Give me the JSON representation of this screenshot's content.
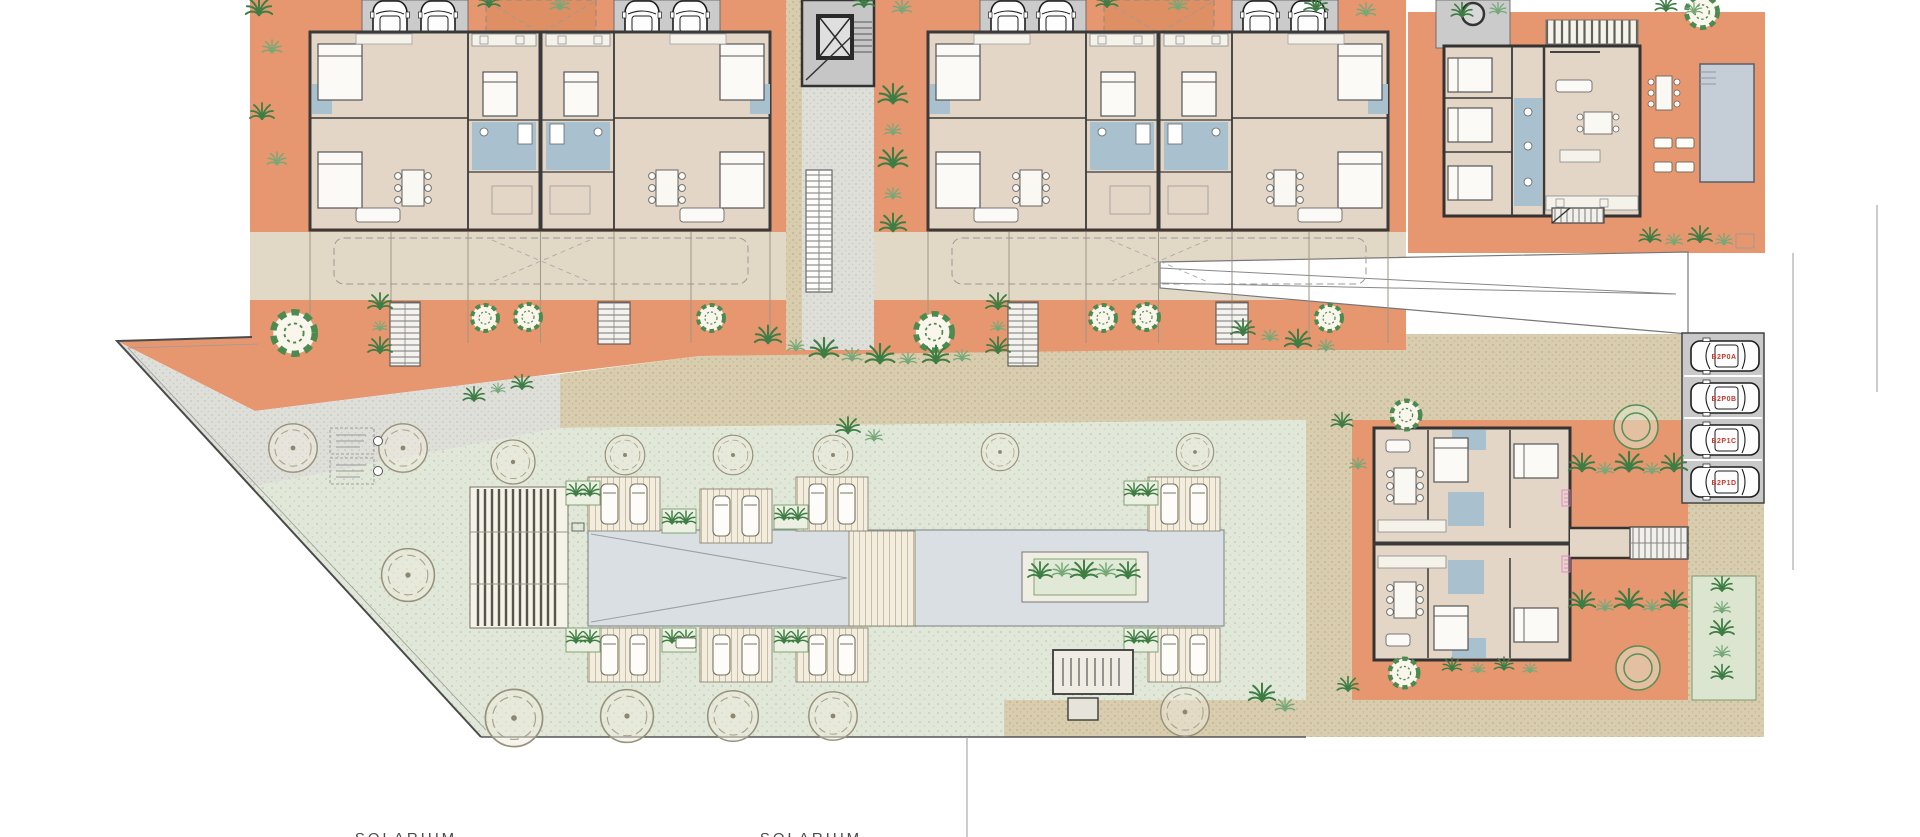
{
  "plan": {
    "type": "residential-site-plan",
    "solarium_labels": [
      {
        "text": "SOLARIUM"
      },
      {
        "text": "SOLARIUM"
      }
    ],
    "parking": {
      "spaces": [
        {
          "label": "B2P0A"
        },
        {
          "label": "B2P0B"
        },
        {
          "label": "B2P1C"
        },
        {
          "label": "B2P1D"
        }
      ],
      "label_color": "#C03A2E"
    },
    "annotations": {
      "tree_note_boxes": 2,
      "pink_unit_tags": 2,
      "legible": false
    },
    "colors": {
      "terracotta_terrace": "#E6976F",
      "building_interior": "#E4D6C6",
      "walls": "#3A3A3A",
      "bathroom_blue": "#A9C0CF",
      "pool_water": "#DADFE3",
      "lawn_green": "#E1E8D9",
      "paving_tan": "#D9CDAF",
      "concrete_gray": "#DFDFDA",
      "garage_gray": "#CBCBCB",
      "drive_beige": "#E2D8C6",
      "vegetation_dark": "#3E7D44",
      "vegetation_light": "#76A878",
      "parking_label_red": "#C03A2E",
      "unit_tag_pink": "#E77FC6"
    },
    "features": [
      "apartment-duplex-block-a",
      "apartment-duplex-block-b",
      "central-stair-walkway",
      "villa-with-pool",
      "duplex-building-east",
      "communal-pool",
      "pergola",
      "sun-deck-modules",
      "parking-spaces",
      "palm-landscaping",
      "solarium-axis"
    ]
  }
}
